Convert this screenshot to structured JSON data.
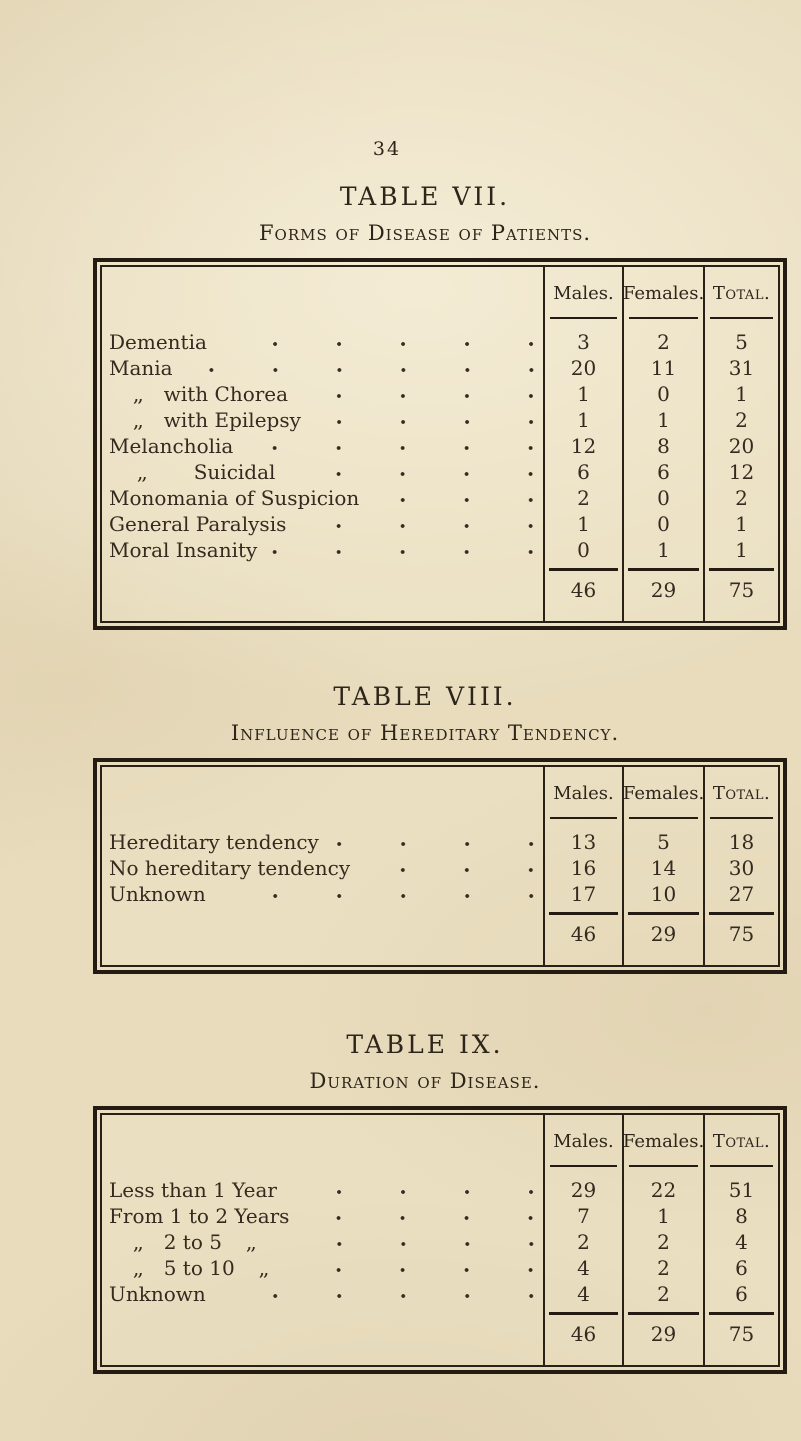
{
  "page": {
    "number": "34",
    "paper_color": "#e8dcbd",
    "ink_color": "#2a2116"
  },
  "tables": [
    {
      "title": "TABLE VII.",
      "subtitle": "Forms of Disease of Patients.",
      "columns": [
        "Males.",
        "Females.",
        "Total."
      ],
      "rows": [
        {
          "pre": "",
          "ind": 0,
          "label": "Dementia",
          "post": "",
          "v": [
            "3",
            "2",
            "5"
          ]
        },
        {
          "pre": "",
          "ind": 0,
          "label": "Mania",
          "post": "",
          "v": [
            "20",
            "11",
            "31"
          ]
        },
        {
          "pre": ",,",
          "ind": 1,
          "label": "with Chorea",
          "post": "",
          "v": [
            "1",
            "0",
            "1"
          ]
        },
        {
          "pre": ",,",
          "ind": 1,
          "label": "with Epilepsy",
          "post": "",
          "v": [
            "1",
            "1",
            "2"
          ]
        },
        {
          "pre": "",
          "ind": 0,
          "label": "Melancholia",
          "post": "",
          "v": [
            "12",
            "8",
            "20"
          ]
        },
        {
          "pre": ",,",
          "ind": 2,
          "label": "Suicidal",
          "post": "",
          "v": [
            "6",
            "6",
            "12"
          ]
        },
        {
          "pre": "",
          "ind": 0,
          "label": "Monomania of Suspicion",
          "post": "",
          "v": [
            "2",
            "0",
            "2"
          ]
        },
        {
          "pre": "",
          "ind": 0,
          "label": "General Paralysis",
          "post": "",
          "v": [
            "1",
            "0",
            "1"
          ]
        },
        {
          "pre": "",
          "ind": 0,
          "label": "Moral Insanity",
          "post": "",
          "v": [
            "0",
            "1",
            "1"
          ]
        }
      ],
      "totals": [
        "46",
        "29",
        "75"
      ]
    },
    {
      "title": "TABLE VIII.",
      "subtitle": "Influence of Hereditary Tendency.",
      "columns": [
        "Males.",
        "Females.",
        "Total."
      ],
      "rows": [
        {
          "pre": "",
          "ind": 0,
          "label": "Hereditary tendency",
          "post": "",
          "v": [
            "13",
            "5",
            "18"
          ]
        },
        {
          "pre": "",
          "ind": 0,
          "label": "No hereditary tendency",
          "post": "",
          "v": [
            "16",
            "14",
            "30"
          ]
        },
        {
          "pre": "",
          "ind": 0,
          "label": "Unknown",
          "post": "",
          "v": [
            "17",
            "10",
            "27"
          ]
        }
      ],
      "totals": [
        "46",
        "29",
        "75"
      ]
    },
    {
      "title": "TABLE IX.",
      "subtitle": "Duration of Disease.",
      "columns": [
        "Males.",
        "Females.",
        "Total."
      ],
      "rows": [
        {
          "pre": "",
          "ind": 0,
          "label": "Less than 1 Year",
          "post": "",
          "v": [
            "29",
            "22",
            "51"
          ]
        },
        {
          "pre": "",
          "ind": 0,
          "label": "From 1 to 2 Years",
          "post": "",
          "v": [
            "7",
            "1",
            "8"
          ]
        },
        {
          "pre": ",,",
          "ind": 1,
          "label": "2 to 5",
          "post": ",,",
          "v": [
            "2",
            "2",
            "4"
          ]
        },
        {
          "pre": ",,",
          "ind": 1,
          "label": "5 to 10",
          "post": ",,",
          "v": [
            "4",
            "2",
            "6"
          ]
        },
        {
          "pre": "",
          "ind": 0,
          "label": "Unknown",
          "post": "",
          "v": [
            "4",
            "2",
            "6"
          ]
        }
      ],
      "totals": [
        "46",
        "29",
        "75"
      ]
    }
  ]
}
